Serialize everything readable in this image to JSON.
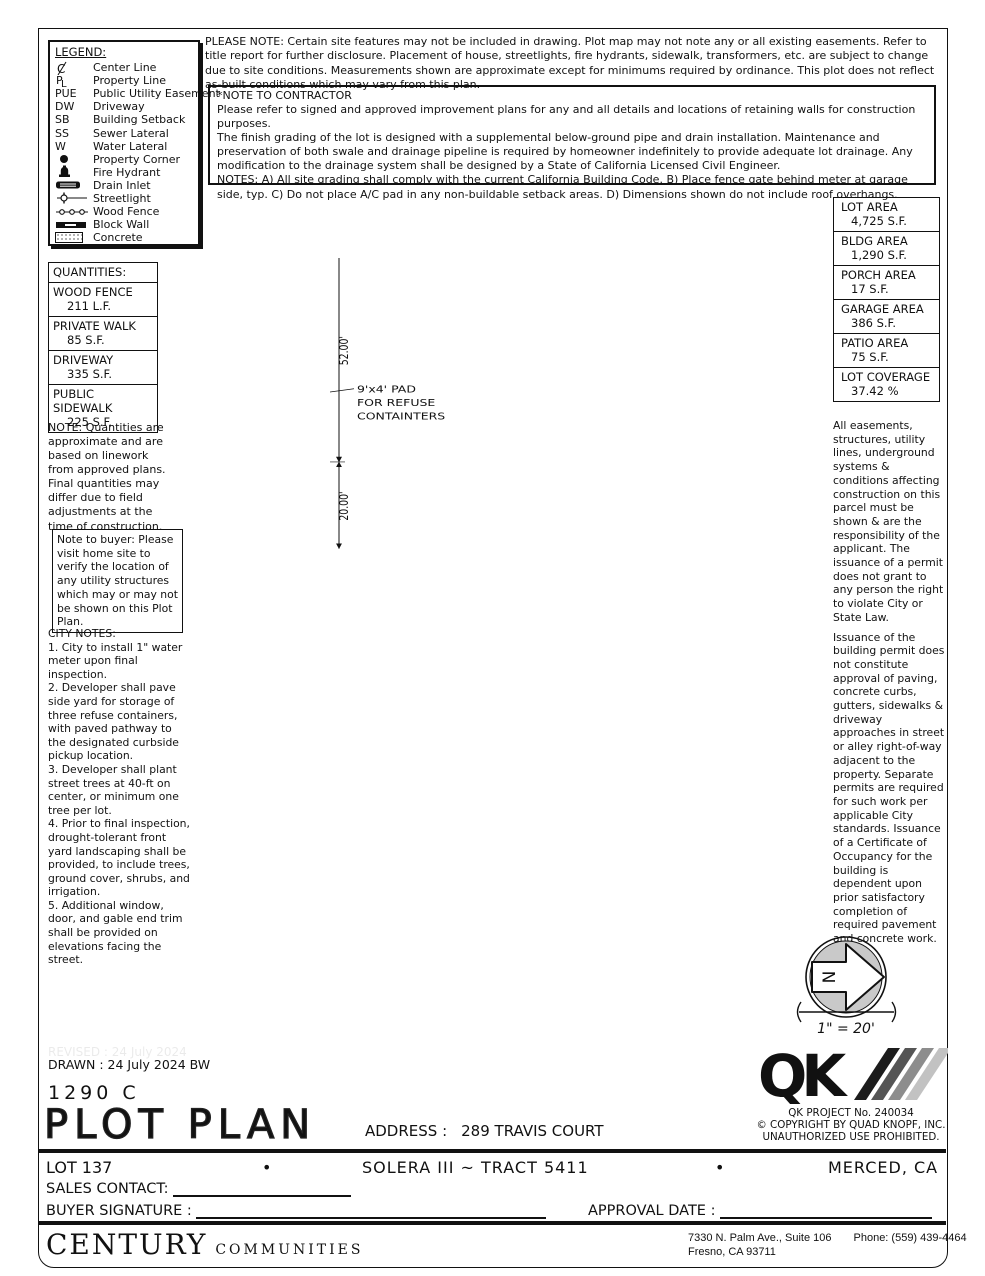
{
  "legend": {
    "title": "LEGEND:",
    "items": [
      {
        "abbr": "",
        "label": "Center Line"
      },
      {
        "abbr": "",
        "label": "Property Line"
      },
      {
        "abbr": "PUE",
        "label": "Public Utility Easement"
      },
      {
        "abbr": "DW",
        "label": "Driveway"
      },
      {
        "abbr": "SB",
        "label": "Building Setback"
      },
      {
        "abbr": "SS",
        "label": "Sewer Lateral"
      },
      {
        "abbr": "W",
        "label": "Water Lateral"
      },
      {
        "abbr": "",
        "label": "Property Corner"
      },
      {
        "abbr": "",
        "label": "Fire Hydrant"
      },
      {
        "abbr": "",
        "label": "Drain Inlet"
      },
      {
        "abbr": "",
        "label": "Streetlight"
      },
      {
        "abbr": "",
        "label": "Wood Fence"
      },
      {
        "abbr": "",
        "label": "Block Wall"
      },
      {
        "abbr": "",
        "label": "Concrete"
      }
    ]
  },
  "notes": {
    "please_note": "PLEASE NOTE:  Certain site features may not be included in drawing.  Plot map may not note any or all existing easements. Refer to title report for further disclosure.  Placement of house, streetlights, fire hydrants, sidewalk, transformers, etc. are subject to change due to site conditions.  Measurements shown are approximate except for minimums required by ordinance.  This plot does not reflect as-built conditions which may vary from this plan.",
    "contractor_title": "*NOTE TO CONTRACTOR",
    "contractor_p1": "Please refer to signed and approved improvement plans for any and all details and locations of retaining walls for construction purposes.",
    "contractor_p2": "The finish grading of the lot is designed with a supplemental below-ground pipe and drain installation.  Maintenance and preservation of both swale and drainage pipeline is required by homeowner indefinitely to provide adequate lot drainage.  Any modification to the drainage system shall be designed by a State of California Licensed Civil Engineer.",
    "contractor_p3": "NOTES:  A) All site grading shall comply with the current California Building Code.  B) Place fence gate behind meter at garage side, typ.  C) Do not place A/C pad in any non-buildable setback areas.  D) Dimensions shown do not include roof overhangs.",
    "buyer_note": "Note to buyer: Please visit home site to verify the location of any utility structures which may or may not be shown on this Plot Plan.",
    "city_title": "CITY NOTES:",
    "city_items": [
      "1. City to install 1\" water meter upon final inspection.",
      "2. Developer shall pave side yard for storage of three refuse containers, with paved pathway to the designated curbside pickup location.",
      "3. Developer shall plant street trees at 40-ft on center, or minimum one tree per lot.",
      "4. Prior to final inspection, drought-tolerant front yard landscaping shall be provided, to include trees, ground cover, shrubs, and irrigation.",
      "5. Additional window, door, and gable end trim shall be provided on elevations facing the street."
    ],
    "right_p1": "All easements, structures, utility lines, underground systems & conditions affecting construction on this parcel must be shown & are the responsibility of the applicant. The issuance of a permit does not grant to any person the right to violate City or State Law.",
    "right_p2": "Issuance of the building permit does not constitute approval of paving, concrete curbs, gutters, sidewalks & driveway approaches in street or alley right-of-way adjacent to the property. Separate permits are required for such work per applicable City standards. Issuance of a Certificate of Occupancy for the building is dependent upon prior satisfactory completion of required pavement and concrete work."
  },
  "quantities": {
    "title": "QUANTITIES:",
    "rows": [
      {
        "name": "WOOD FENCE",
        "value": "211 L.F."
      },
      {
        "name": "PRIVATE WALK",
        "value": "85 S.F."
      },
      {
        "name": "DRIVEWAY",
        "value": "335 S.F."
      },
      {
        "name": "PUBLIC SIDEWALK",
        "value": "225 S.F."
      }
    ],
    "note": "NOTE: Quantities are approximate and are based on linework from approved plans.  Final quantities may differ due to field adjustments at the time of construction."
  },
  "areas": {
    "rows": [
      {
        "name": "LOT AREA",
        "value": "4,725 S.F."
      },
      {
        "name": "BLDG AREA",
        "value": "1,290 S.F."
      },
      {
        "name": "PORCH AREA",
        "value": "17 S.F."
      },
      {
        "name": "GARAGE AREA",
        "value": "386 S.F."
      },
      {
        "name": "PATIO AREA",
        "value": "75 S.F."
      },
      {
        "name": "LOT COVERAGE",
        "value": "37.42 %"
      }
    ]
  },
  "plot": {
    "lot_number": "137",
    "street": "TRAVIS COURT",
    "plan": "PLAN 1290",
    "elev": "ELEV C",
    "garage1": "2 - CAR",
    "garage2": "GARAGE",
    "porch": "PORCH",
    "gate": "GATE",
    "patio": "COV'D PATIO",
    "ac": "AC",
    "dw": "DW",
    "pl": "PL",
    "w": "W",
    "ss": "SS",
    "dim_top": "45.00'",
    "dim_bottom": "45.00'",
    "dim_33": "33.00'",
    "dim_52": "52.00'",
    "dim_20": "20.00'",
    "dim_105": "105.00'",
    "dim_23": "23.00'",
    "dim_6": "6.00'",
    "dim_2029": "20.29'",
    "sb10": "10' SB",
    "sb5": "5' SB",
    "sb15": "15' SB",
    "pue10": "10' PUE",
    "pad1": "9'x4' PAD",
    "pad2": "FOR REFUSE",
    "pad3": "CONTAINTERS"
  },
  "compass": {
    "n": "N",
    "scale": "1\" = 20'"
  },
  "qk": {
    "logo": "QK",
    "project": "QK PROJECT No. 240034",
    "copyright": "©  COPYRIGHT BY QUAD KNOPF, INC.",
    "unauthorized": "UNAUTHORIZED USE PROHIBITED."
  },
  "title_block": {
    "revised": "REVISED :  24 July 2024",
    "drawn": "DRAWN :  24 July 2024  BW",
    "plan_code": "1290  C",
    "title": "PLOT PLAN",
    "address_label": "ADDRESS :",
    "address": "289 TRAVIS COURT",
    "lot": "LOT 137",
    "bullet1": "•",
    "tract": "SOLERA III ~ TRACT 5411",
    "bullet2": "•",
    "city": "MERCED, CA",
    "sales_label": "SALES CONTACT:",
    "buyer_label": "BUYER SIGNATURE :",
    "approval_label": "APPROVAL DATE :"
  },
  "footer": {
    "company1": "CENTURY",
    "company2": "COMMUNITIES",
    "addr1": "7330 N. Palm Ave., Suite 106",
    "phone": "Phone:  (559) 439-4464",
    "addr2": "Fresno, CA  93711"
  }
}
